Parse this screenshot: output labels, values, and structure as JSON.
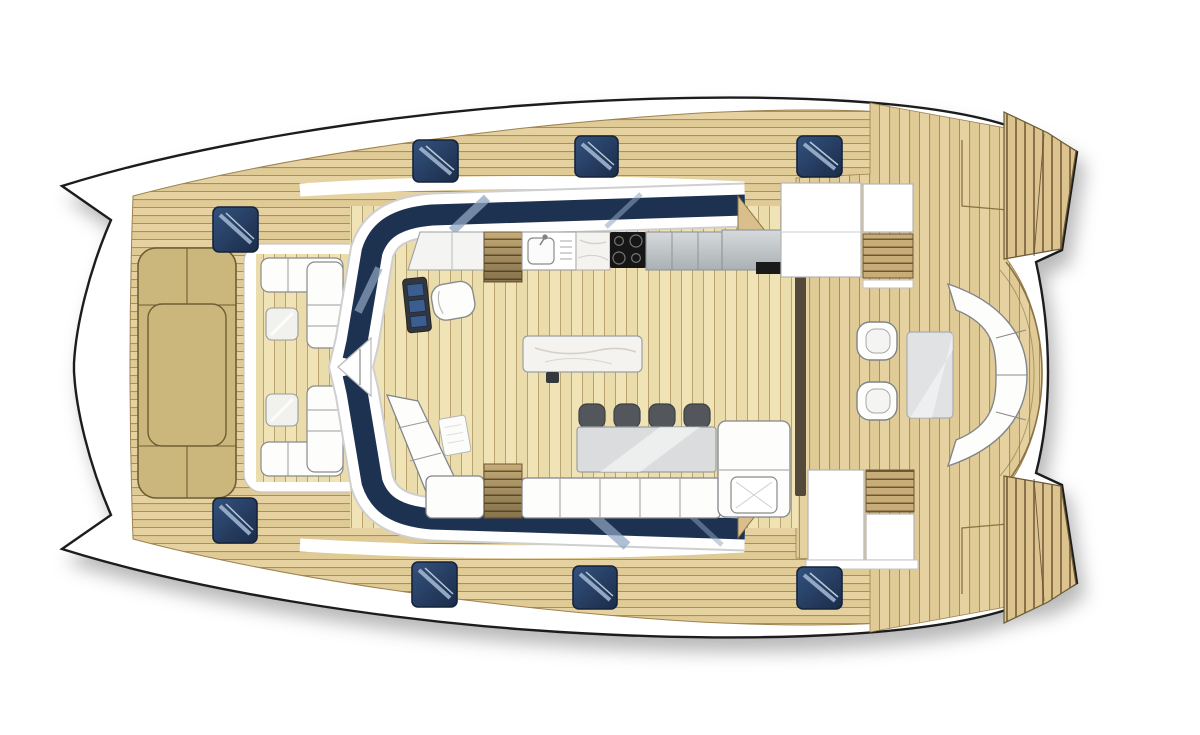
{
  "image": {
    "kind": "catamaran-yacht-deck-plan",
    "view": "top-down-floor-plan",
    "background": "#ffffff"
  },
  "colors": {
    "hullFill": "#ffffff",
    "hullStroke": "#1f1f1f",
    "deckPlank": "#e6d2a1",
    "deckPlankAlt": "#e0ca96",
    "plankLine": "#a0854f",
    "interiorPlank": "#f0e3b6",
    "interiorPlankAlt": "#ebddab",
    "interiorLine": "#b59c6a",
    "sunpad": "#cbb67c",
    "sunpadStroke": "#6e5e35",
    "navyBand": "#1d3150",
    "hatchDark": "#1b2c49",
    "hatchLight": "#33527e",
    "hatchStripe": "#9fb4cd",
    "furnitureWhite": "#fdfdfc",
    "furnitureStroke": "#82868a",
    "greyCabinet": "#c9cdd0",
    "greyCabinetDark": "#aab0b4",
    "cooktopBlack": "#161616",
    "marble": "#f4f3f0",
    "tableGrey": "#dadcdd",
    "chairDark": "#53575b",
    "stepWood": "#c8ad78",
    "stepLine": "#6d5835",
    "transomWood": "#dcc390",
    "transomLine": "#7a643c",
    "doorFrame": "#55493c",
    "rimLine": "#8a7347"
  },
  "components": {
    "hull": "catamaran twin-bow hull",
    "foredeck_sunpad": "khaki sun lounger pad",
    "bow_hatches": 2,
    "deck_hatches_top": 3,
    "deck_hatches_bottom": 3,
    "forward_cockpit_benches": 2,
    "forward_cockpit_tables": 2,
    "helm_station": "console with seat",
    "galley_units": [
      "counter",
      "companionway-steps",
      "sink",
      "marble-counter",
      "cooktop-4-burner",
      "cabinets",
      "fridge-module"
    ],
    "center_island": "marble island",
    "dining_chairs": 4,
    "dining_table": 1,
    "salon_sofa_sections": 3,
    "aft_chairs": 2,
    "aft_coffee_table": 1,
    "aft_sofa_cushions": 4,
    "transom_platforms": 2,
    "cooktop_burners": 4
  }
}
